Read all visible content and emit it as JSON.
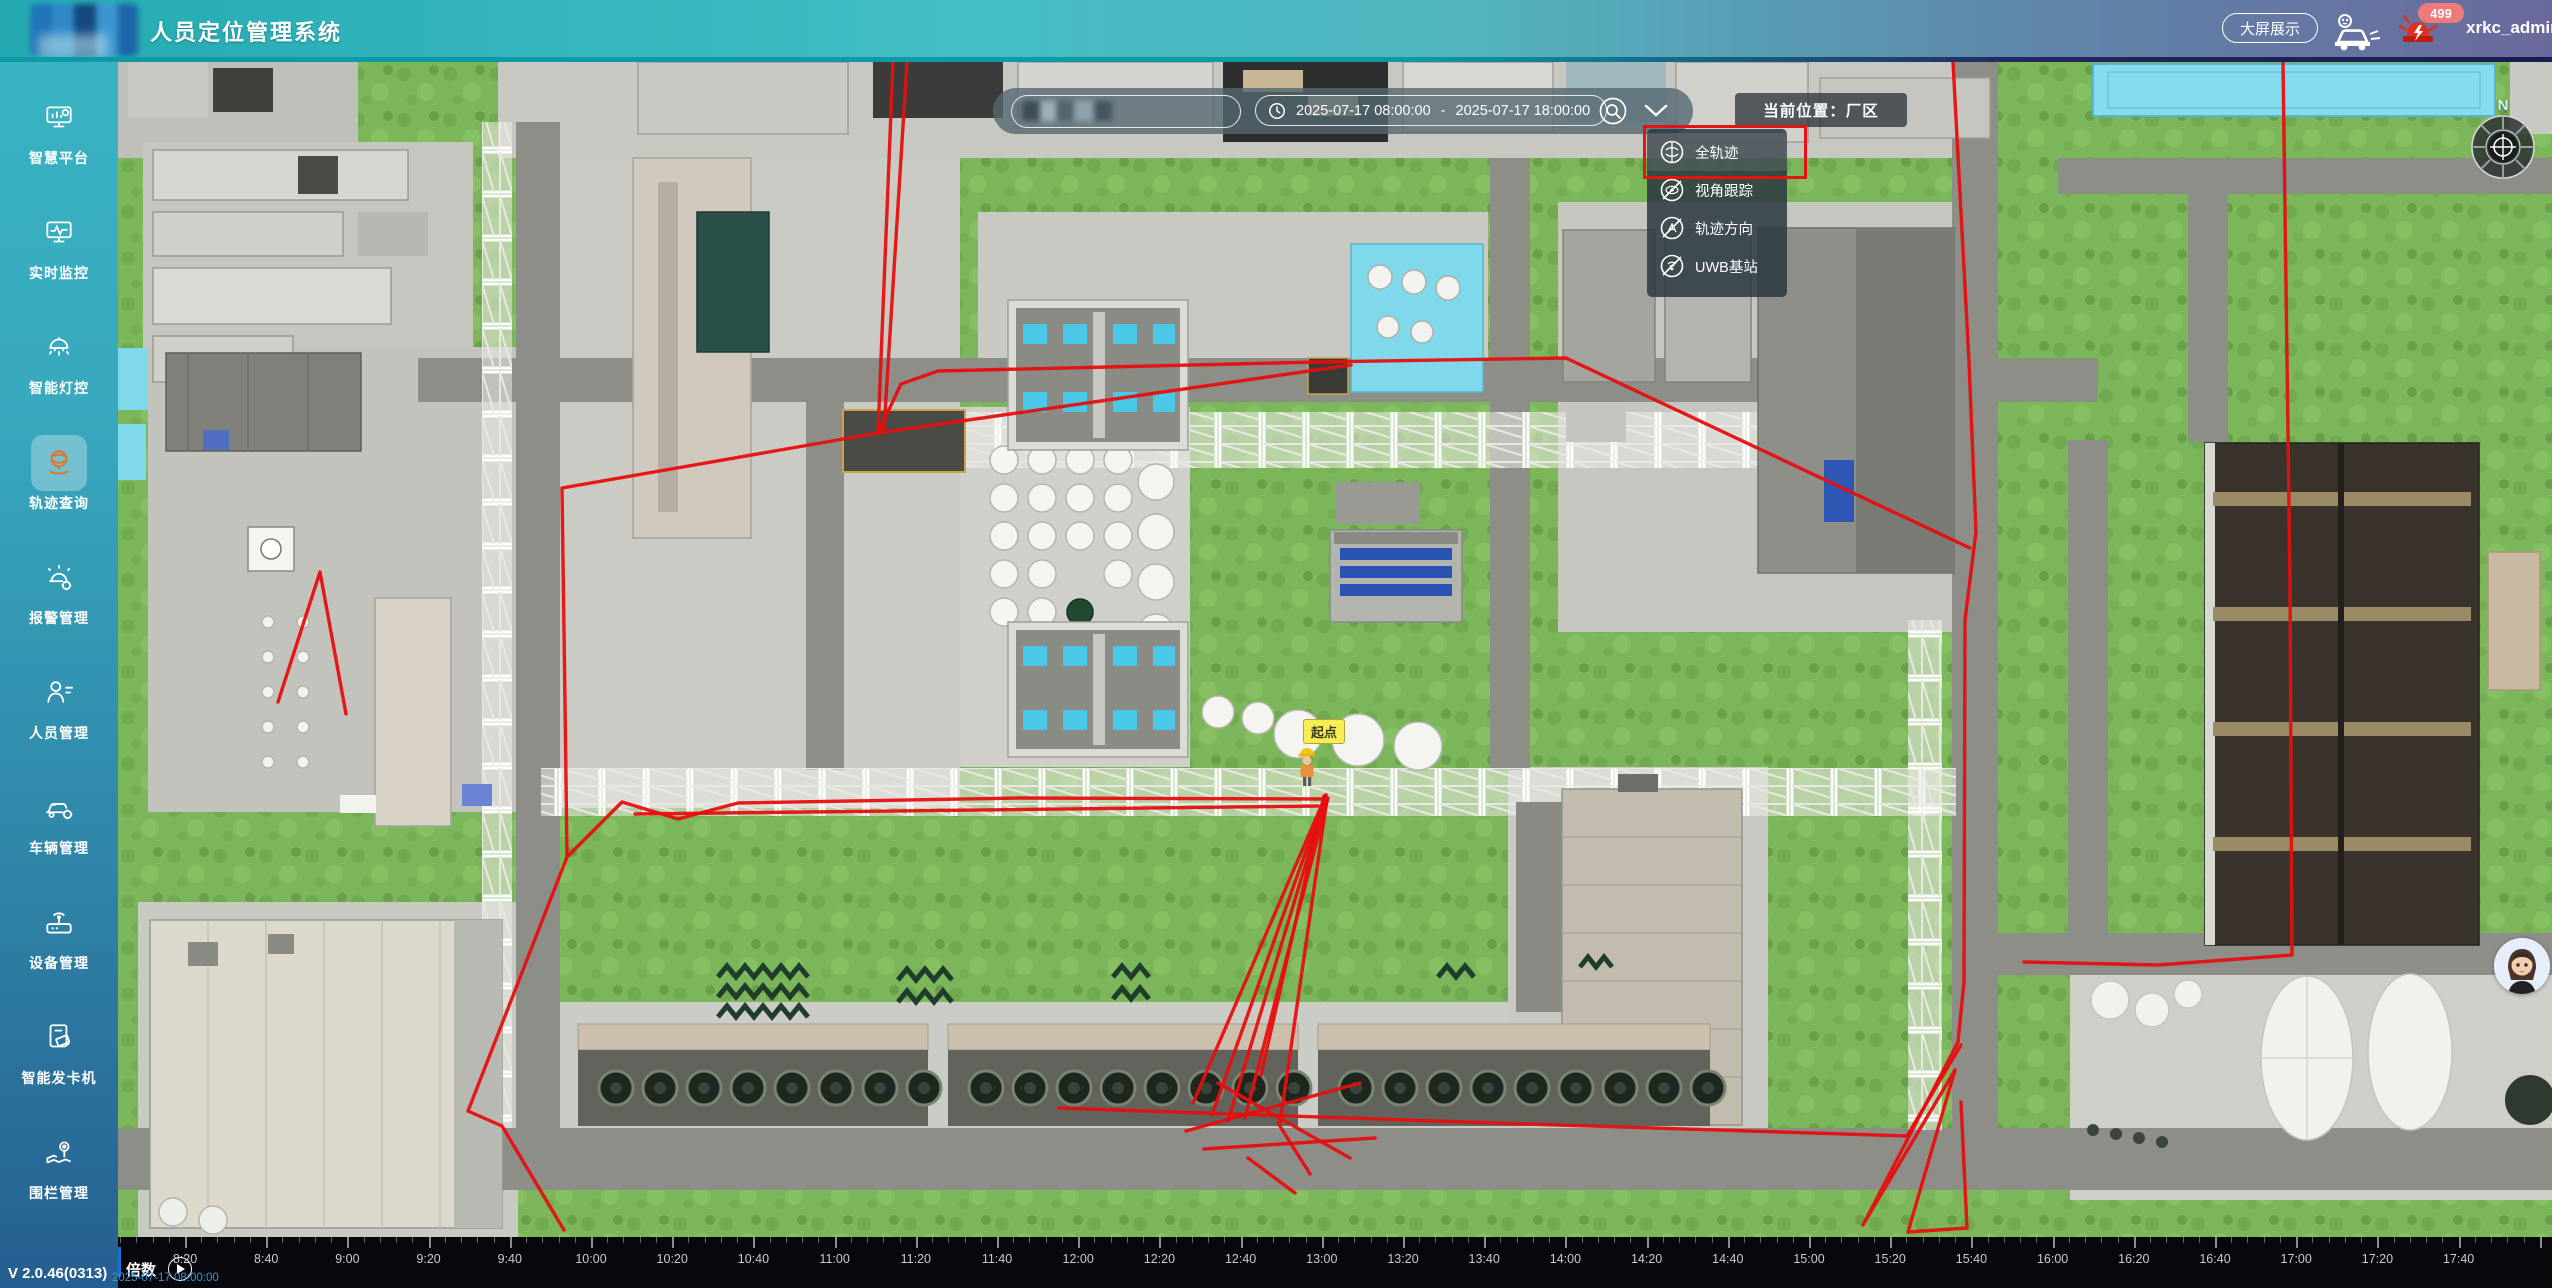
{
  "header": {
    "title": "人员定位管理系统",
    "screen_button": "大屏展示",
    "badge_count": "499",
    "username": "xrkc_admin"
  },
  "sidebar": {
    "items": [
      {
        "key": "smart-platform",
        "label": "智慧平台"
      },
      {
        "key": "realtime-monitor",
        "label": "实时监控"
      },
      {
        "key": "smart-lighting",
        "label": "智能灯控"
      },
      {
        "key": "track-query",
        "label": "轨迹查询",
        "active": true
      },
      {
        "key": "alarm-management",
        "label": "报警管理"
      },
      {
        "key": "personnel-management",
        "label": "人员管理"
      },
      {
        "key": "vehicle-management",
        "label": "车辆管理"
      },
      {
        "key": "device-management",
        "label": "设备管理"
      },
      {
        "key": "card-dispenser",
        "label": "智能发卡机"
      },
      {
        "key": "fence-management",
        "label": "围栏管理"
      }
    ],
    "version": "V 2.0.46(0313)"
  },
  "toolbar": {
    "date_start": "2025-07-17 08:00:00",
    "date_separator": "-",
    "date_end": "2025-07-17 18:00:00",
    "location_label": "当前位置：厂区"
  },
  "dropdown": {
    "items": [
      {
        "label": "全轨迹",
        "selected": true,
        "disabled": false
      },
      {
        "label": "视角跟踪",
        "selected": false,
        "disabled": true
      },
      {
        "label": "轨迹方向",
        "selected": false,
        "disabled": true
      },
      {
        "label": "UWB基站",
        "selected": false,
        "disabled": true
      }
    ],
    "annotation_color": "#e51313"
  },
  "map": {
    "compass_label": "N",
    "start_marker": "起点",
    "trajectory": {
      "color": "#e60f0f",
      "paths": [
        [
          [
            775,
            0
          ],
          [
            760,
            371
          ]
        ],
        [
          [
            789,
            0
          ],
          [
            766,
            368
          ]
        ],
        [
          [
            760,
            371
          ],
          [
            783,
            322
          ],
          [
            820,
            309
          ],
          [
            1200,
            300
          ],
          [
            1448,
            296
          ],
          [
            1852,
            486
          ]
        ],
        [
          [
            760,
            371
          ],
          [
            1233,
            303
          ]
        ],
        [
          [
            1835,
            0
          ],
          [
            1851,
            300
          ],
          [
            1858,
            470
          ],
          [
            1847,
            558
          ],
          [
            1846,
            920
          ],
          [
            1840,
            980
          ],
          [
            1745,
            1163
          ],
          [
            1837,
            1008
          ],
          [
            1790,
            1170
          ],
          [
            1849,
            1166
          ],
          [
            1843,
            1040
          ]
        ],
        [
          [
            2165,
            0
          ],
          [
            2172,
            520
          ],
          [
            2174,
            893
          ],
          [
            2040,
            903
          ],
          [
            1906,
            900
          ]
        ],
        [
          [
            760,
            371
          ],
          [
            444,
            426
          ],
          [
            447,
            640
          ],
          [
            449,
            795
          ],
          [
            350,
            1049
          ],
          [
            384,
            1064
          ],
          [
            446,
            1168
          ]
        ],
        [
          [
            160,
            640
          ],
          [
            202,
            510
          ],
          [
            228,
            652
          ]
        ],
        [
          [
            449,
            795
          ],
          [
            504,
            740
          ],
          [
            560,
            757
          ],
          [
            620,
            741
          ],
          [
            900,
            736
          ],
          [
            1205,
            737
          ]
        ],
        [
          [
            517,
            752
          ],
          [
            1200,
            744
          ]
        ],
        [
          [
            1208,
            733
          ],
          [
            1075,
            1041
          ]
        ],
        [
          [
            1208,
            733
          ],
          [
            1094,
            1053
          ]
        ],
        [
          [
            1208,
            735
          ],
          [
            1110,
            1059
          ]
        ],
        [
          [
            1210,
            736
          ],
          [
            1127,
            1056
          ]
        ],
        [
          [
            1206,
            734
          ],
          [
            1143,
            1013
          ]
        ],
        [
          [
            1209,
            737
          ],
          [
            1162,
            1061
          ]
        ],
        [
          [
            941,
            1046
          ],
          [
            1376,
            1061
          ],
          [
            1789,
            1074
          ]
        ],
        [
          [
            1068,
            1069
          ],
          [
            1242,
            1021
          ]
        ],
        [
          [
            1086,
            1087
          ],
          [
            1257,
            1076
          ]
        ],
        [
          [
            1100,
            1021
          ],
          [
            1232,
            1096
          ]
        ],
        [
          [
            1160,
            1061
          ],
          [
            1192,
            1112
          ]
        ],
        [
          [
            1130,
            1096
          ],
          [
            1177,
            1131
          ]
        ],
        [
          [
            1843,
            983
          ],
          [
            1789,
            1074
          ]
        ]
      ]
    }
  },
  "timeline": {
    "multiplier_label": "倍数",
    "current_time": "2025-07-17 08:00:00",
    "labels": [
      "8:20",
      "8:40",
      "9:00",
      "9:20",
      "9:40",
      "10:00",
      "10:20",
      "10:40",
      "11:00",
      "11:20",
      "11:40",
      "12:00",
      "12:20",
      "12:40",
      "13:00",
      "13:20",
      "13:40",
      "14:00",
      "14:20",
      "14:40",
      "15:00",
      "15:20",
      "15:40",
      "16:00",
      "16:20",
      "16:40",
      "17:00",
      "17:20",
      "17:40"
    ]
  }
}
